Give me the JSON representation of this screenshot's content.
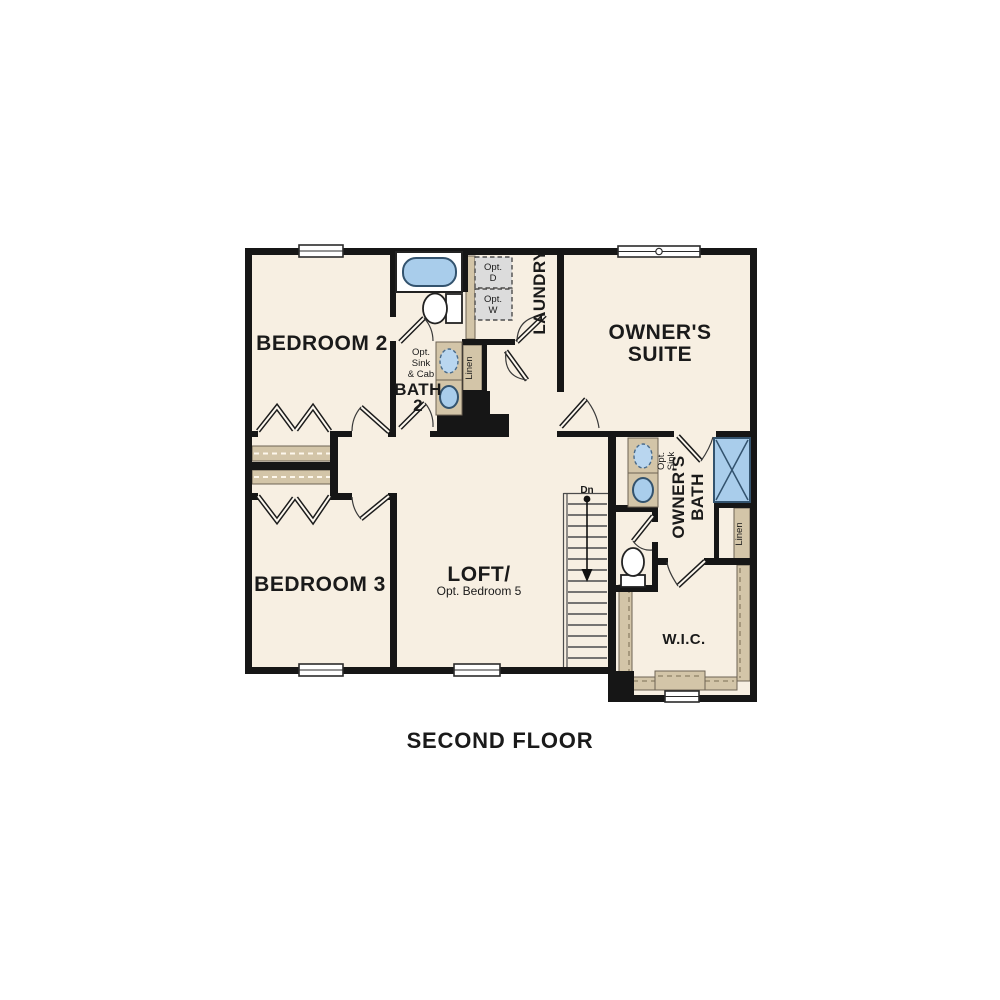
{
  "page": {
    "caption": "SECOND FLOOR",
    "background_color": "#ffffff"
  },
  "floor_plan": {
    "type": "residential-second-floor-plan",
    "colors": {
      "floor": "#f7efe2",
      "walls": "#161616",
      "closet_shelf": "#d3c5a8",
      "fixture_blue": "#a9cdeb",
      "optional_appliance_gray": "#dcdcdc"
    },
    "rooms": [
      {
        "id": "bedroom2",
        "label": "BEDROOM 2"
      },
      {
        "id": "bedroom3",
        "label": "BEDROOM 3"
      },
      {
        "id": "owners_suite",
        "label": "OWNER'S SUITE"
      },
      {
        "id": "loft",
        "label": "LOFT/",
        "sublabel": "Opt. Bedroom 5"
      },
      {
        "id": "laundry",
        "label": "LAUNDRY"
      },
      {
        "id": "bath2",
        "label": "BATH 2"
      },
      {
        "id": "owners_bath",
        "label": "OWNER'S BATH"
      },
      {
        "id": "wic",
        "label": "W.I.C."
      }
    ],
    "fixtures": [
      "bathtub-icon",
      "toilet-icon",
      "sink-icon",
      "shower-icon",
      "washer-box",
      "dryer-box",
      "stairs-down-arrow"
    ],
    "labels": {
      "bedroom2": "BEDROOM 2",
      "bedroom3": "BEDROOM 3",
      "owners_suite_1": "OWNER'S",
      "owners_suite_2": "SUITE",
      "loft_1": "LOFT/",
      "loft_2": "Opt. Bedroom 5",
      "laundry": "LAUNDRY",
      "bath2_1": "BATH",
      "bath2_2": "2",
      "owners_bath_1": "OWNER'S",
      "owners_bath_2": "BATH",
      "wic": "W.I.C.",
      "linen_hall": "Linen",
      "linen_owners": "Linen",
      "opt_sink_1": "Opt.",
      "opt_sink_2": "Sink",
      "opt_sink_cab_1": "Opt.",
      "opt_sink_cab_2": "Sink",
      "opt_sink_cab_3": "& Cab",
      "opt_d_1": "Opt.",
      "opt_d_2": "D",
      "opt_w_1": "Opt.",
      "opt_w_2": "W",
      "stairs_dn": "Dn",
      "caption": "SECOND FLOOR"
    }
  }
}
